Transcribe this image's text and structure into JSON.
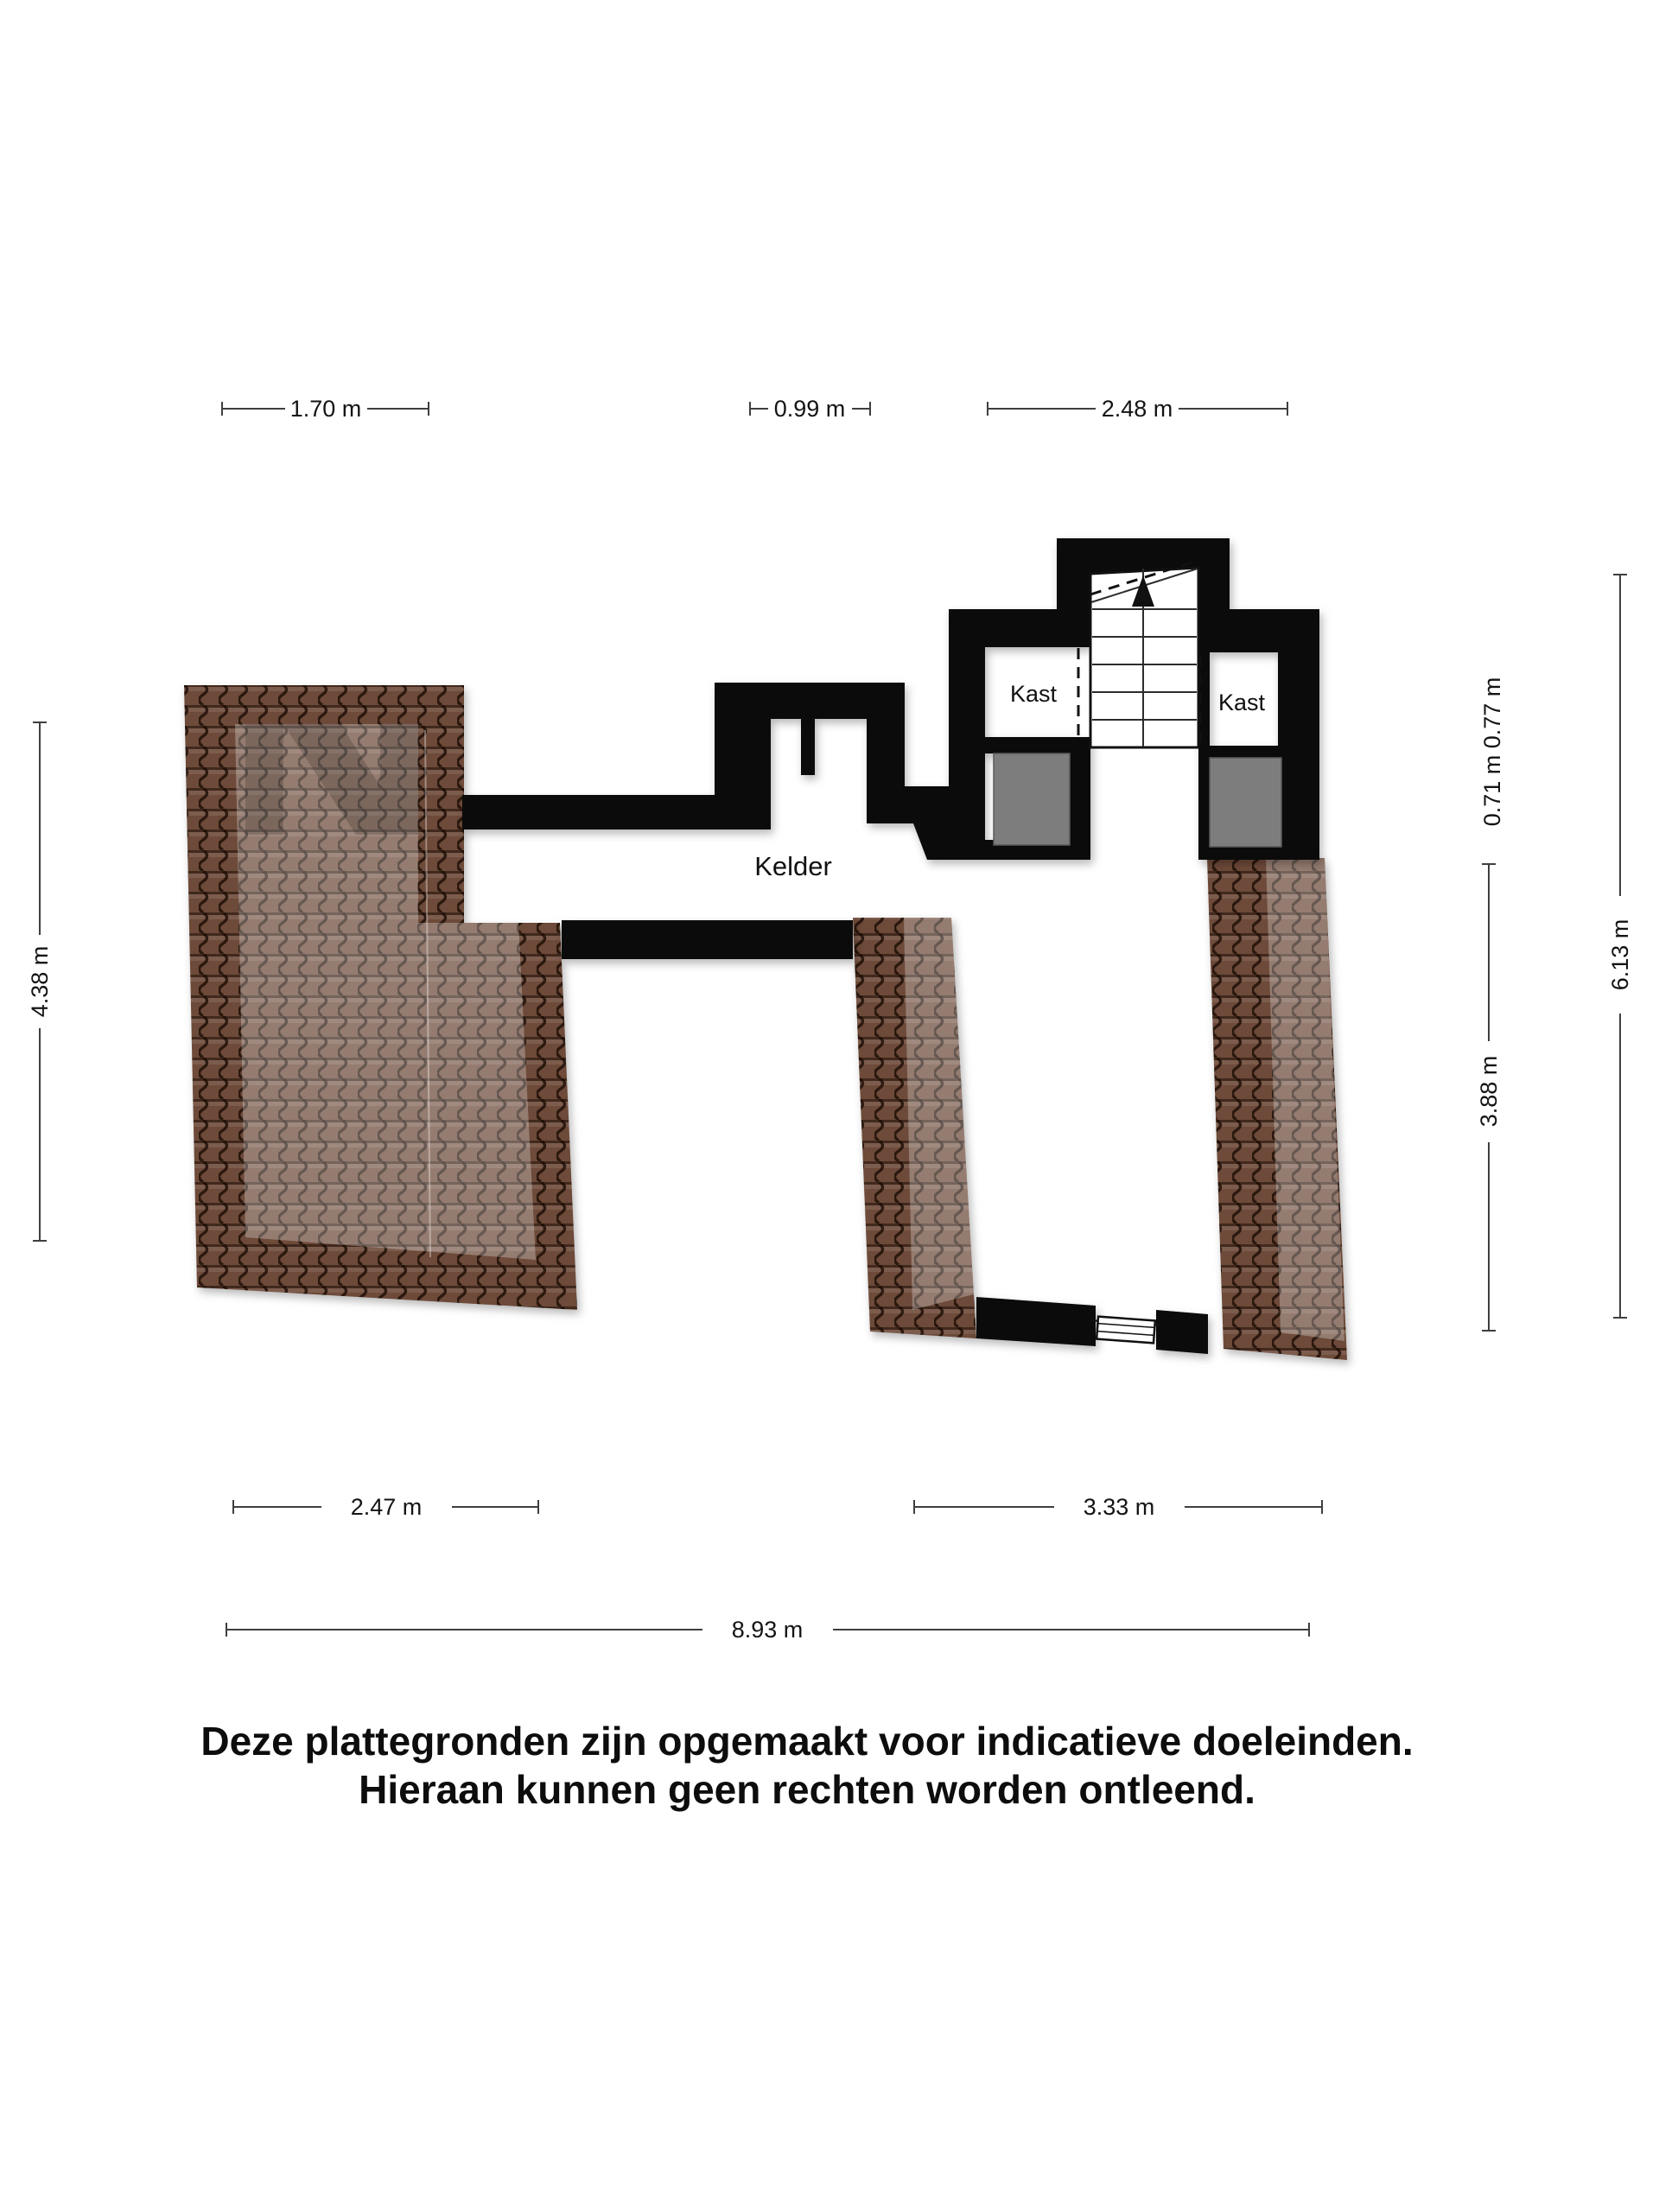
{
  "plan": {
    "rooms": {
      "kelder": {
        "label": "Kelder"
      },
      "kast_left": {
        "label": "Kast"
      },
      "kast_right": {
        "label": "Kast"
      }
    },
    "dimensions": {
      "top": [
        {
          "label": "1.70 m"
        },
        {
          "label": "0.99 m"
        },
        {
          "label": "2.48 m"
        }
      ],
      "left": [
        {
          "label": "4.38 m"
        }
      ],
      "right": [
        {
          "label": "0.71 m 0.77 m"
        },
        {
          "label": "3.88 m"
        },
        {
          "label": "6.13 m"
        }
      ],
      "bottom": [
        {
          "label": "2.47 m"
        },
        {
          "label": "3.33 m"
        },
        {
          "label": "8.93 m"
        }
      ]
    },
    "colors": {
      "wall": "#0b0b0b",
      "brick_base": "#6d4a39",
      "brick_line": "#2a160c",
      "brick_highlight": "#c8a894",
      "gray_block": "#7d7d7d",
      "dimension_line": "#3f3f3f",
      "background": "#ffffff"
    }
  },
  "disclaimer": {
    "line1": "Deze plattegronden zijn opgemaakt voor indicatieve doeleinden.",
    "line2": "Hieraan kunnen geen rechten worden ontleend."
  }
}
